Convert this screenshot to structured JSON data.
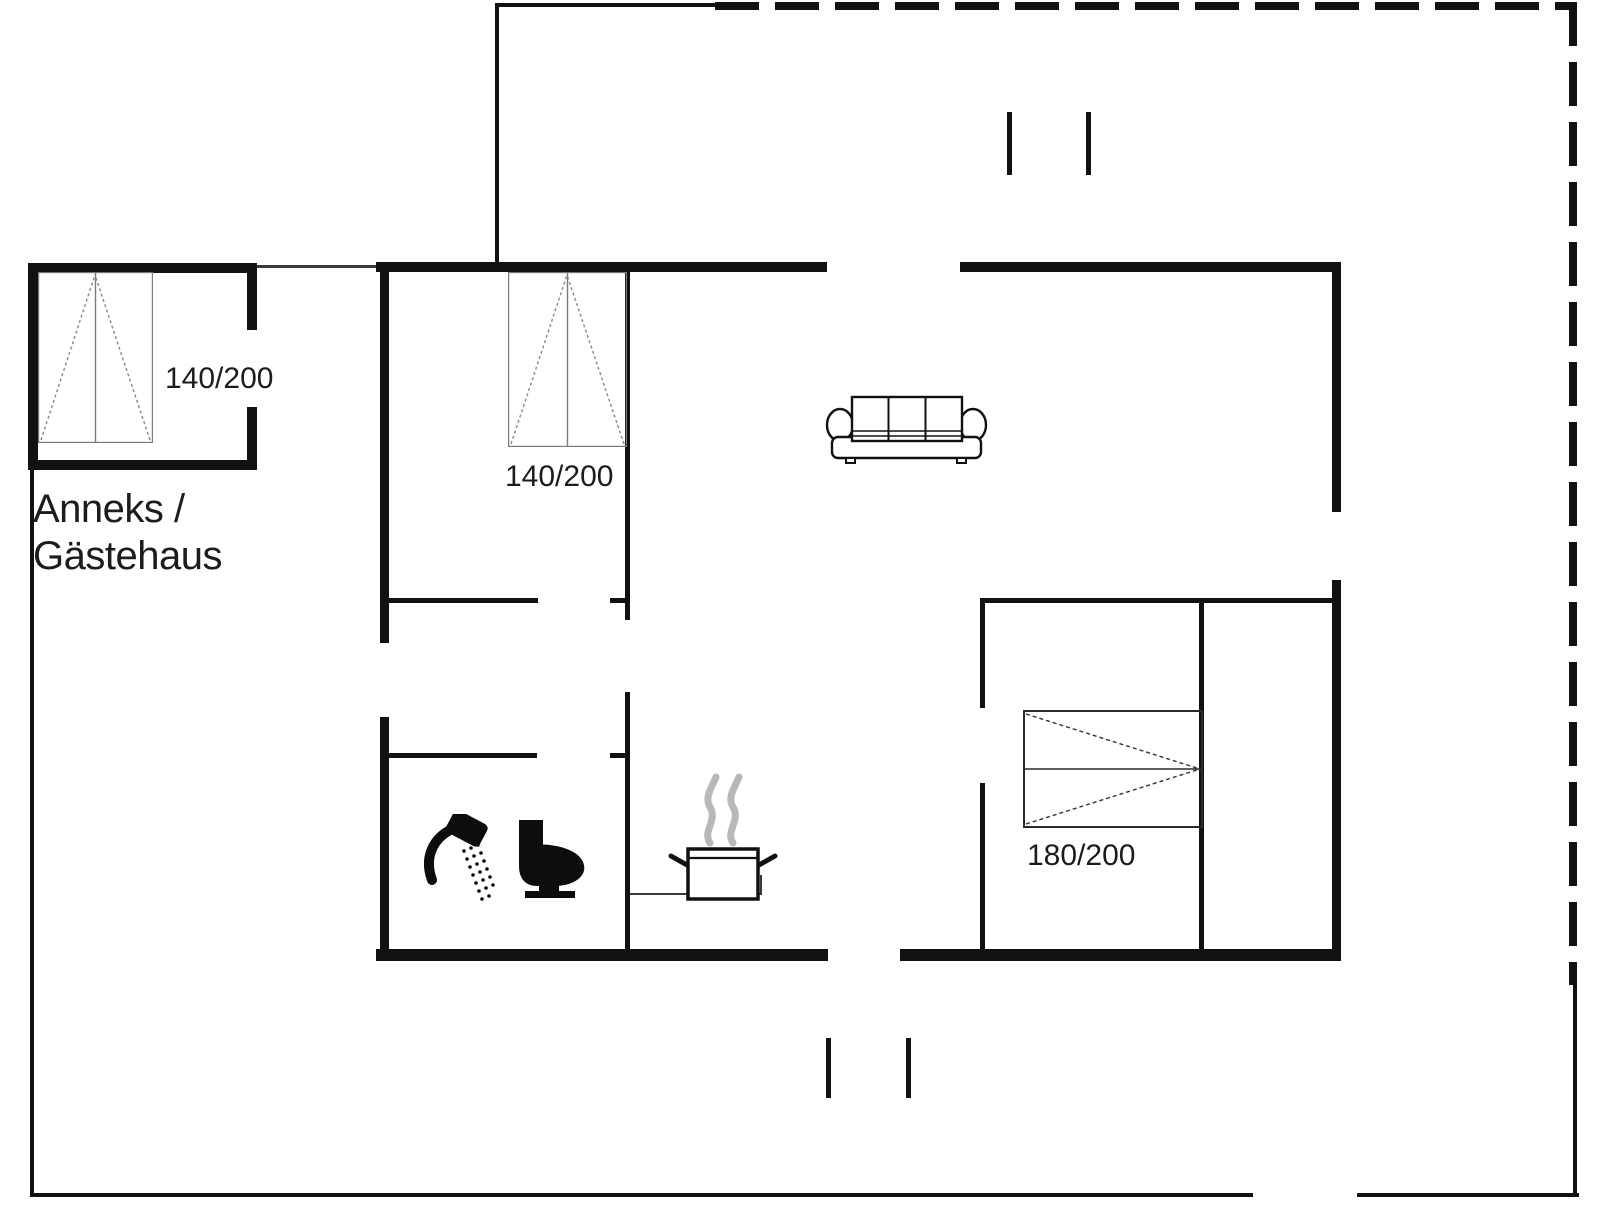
{
  "page": {
    "type": "floor-plan",
    "background": "#ffffff"
  },
  "labels": {
    "annex_name_line1": "Anneks /",
    "annex_name_line2": "Gästehaus",
    "annex_bed_size": "140/200",
    "bedroom1_bed_size": "140/200",
    "bedroom2_bed_size": "180/200"
  },
  "icons": {
    "bathroom": [
      "shower-icon",
      "toilet-icon"
    ],
    "kitchen": [
      "cooking-pot-icon",
      "kitchen-counter"
    ],
    "living_room": [
      "sofa-icon"
    ],
    "bedrooms": [
      "double-bed-icon"
    ],
    "doors": [
      "door-opening-ticks"
    ],
    "boundary": [
      "dashed-terrace-boundary"
    ]
  },
  "colors": {
    "wall": "#111111",
    "text": "#1c1c1c",
    "bed_outline": "#7a7a7a",
    "bed2_outline": "#2a2a2a",
    "steam": "#b8b8b8",
    "background": "#ffffff"
  }
}
